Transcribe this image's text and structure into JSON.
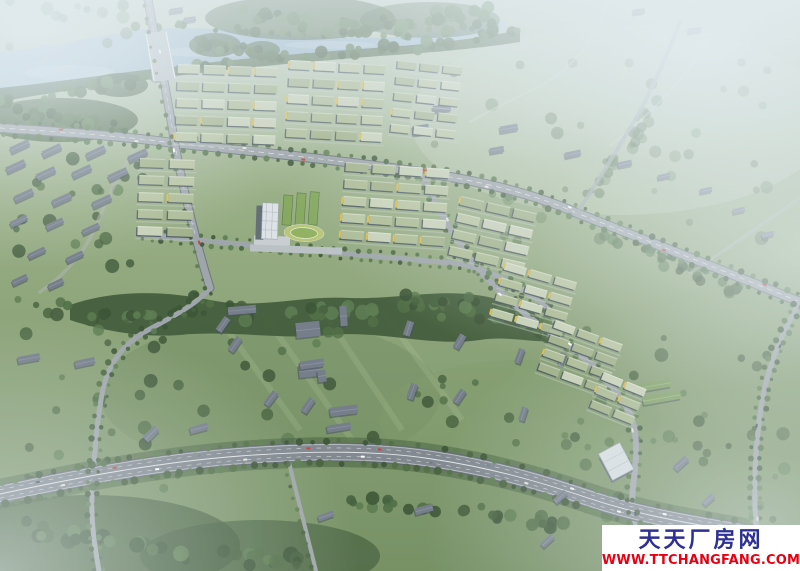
{
  "watermark": {
    "site_name": "天天厂房网",
    "url": "WWW.TTCHANGFANG.COM"
  },
  "scene": {
    "description": "Aerial bird's-eye rendering of an industrial park master plan: river across the top, grid clusters of green-roofed factory buildings with yellow accents, central white office tower with oval running track, tree bands, rural gray-roofed buildings in surrounding fields, and a wide tree-lined highway curving across the bottom, fading into blue-white haze at the edges.",
    "colors": {
      "haze": "#e4edf2",
      "grass_top": "#c3d1c0",
      "grass_mid": "#93a97d",
      "grass_low": "#6f8a5b",
      "water": "#a8c2d4",
      "water_deep": "#8fadc2",
      "tree_deep": "#35502e",
      "road_fill": "#9aa1a6",
      "road_edge": "#666e75",
      "highway_fill": "#7b828a",
      "highway_edge": "#565e66",
      "road_line": "#ffffff",
      "roof_sage": "#a9b88f",
      "roof_pale": "#c2ccae",
      "facade": "#3f4b54",
      "accent_yellow": "#e2b83d",
      "campus_green": "#7fa355",
      "track_ring": "#b5c272",
      "track_field": "#8cae58",
      "gray_roof": "#6d7683",
      "gray_dark": "#3d4650",
      "white_bldg": "#d7dde1",
      "tower": "#dce1e5",
      "wm_navy": "#2e3192",
      "wm_red": "#e60012"
    },
    "tree_shades": [
      "#324b2b",
      "#3d5933",
      "#48673c",
      "#547547"
    ],
    "roof_shades": [
      "#a9b88f",
      "#b6c29d",
      "#9dad83",
      "#c6cfb4"
    ],
    "car_colors": [
      "#f2f4f5",
      "#ffffff",
      "#39434d",
      "#c23b2e",
      "#6b7885",
      "#e8e4d8"
    ],
    "clusters": [
      {
        "id": "a1",
        "x": 178,
        "y": 64,
        "rot": 2,
        "rows": 5,
        "cols": 4,
        "w": 22,
        "h": 9,
        "gx": 4,
        "gy": 8,
        "seed": 11,
        "yellow": 0.3
      },
      {
        "id": "a2",
        "x": 290,
        "y": 60,
        "rot": 3,
        "rows": 5,
        "cols": 4,
        "w": 21,
        "h": 9,
        "gx": 4,
        "gy": 8,
        "seed": 22,
        "yellow": 0.3
      },
      {
        "id": "a3",
        "x": 398,
        "y": 60,
        "rot": 6,
        "rows": 5,
        "cols": 3,
        "w": 19,
        "h": 8,
        "gx": 4,
        "gy": 8,
        "seed": 33,
        "yellow": 0.25
      },
      {
        "id": "b-left",
        "x": 140,
        "y": 158,
        "rot": 2,
        "rows": 5,
        "cols": 2,
        "w": 25,
        "h": 9,
        "gx": 5,
        "gy": 8,
        "seed": 44,
        "yellow": 0.35
      },
      {
        "id": "b-right",
        "x": 346,
        "y": 162,
        "rot": 4,
        "rows": 5,
        "cols": 4,
        "w": 23,
        "h": 9,
        "gx": 4,
        "gy": 8,
        "seed": 55,
        "yellow": 0.35
      },
      {
        "id": "c1",
        "x": 462,
        "y": 196,
        "rot": 13,
        "rows": 4,
        "cols": 3,
        "w": 23,
        "h": 9,
        "gx": 4,
        "gy": 8,
        "seed": 66,
        "yellow": 0.3
      },
      {
        "id": "c2",
        "x": 506,
        "y": 262,
        "rot": 16,
        "rows": 4,
        "cols": 3,
        "w": 22,
        "h": 8,
        "gx": 4,
        "gy": 8,
        "seed": 77,
        "yellow": 0.35
      },
      {
        "id": "c3",
        "x": 556,
        "y": 320,
        "rot": 20,
        "rows": 4,
        "cols": 3,
        "w": 21,
        "h": 8,
        "gx": 4,
        "gy": 7,
        "seed": 88,
        "yellow": 0.4
      },
      {
        "id": "c4",
        "x": 604,
        "y": 372,
        "rot": 22,
        "rows": 3,
        "cols": 2,
        "w": 21,
        "h": 8,
        "gx": 4,
        "gy": 7,
        "seed": 99,
        "yellow": 0.4
      }
    ],
    "gray_buildings": [
      [
        10,
        143,
        20,
        7,
        -25
      ],
      [
        42,
        147,
        20,
        7,
        -25
      ],
      [
        86,
        149,
        20,
        7,
        -25
      ],
      [
        128,
        152,
        20,
        7,
        -25
      ],
      [
        6,
        163,
        20,
        7,
        -25
      ],
      [
        36,
        170,
        20,
        7,
        -25
      ],
      [
        72,
        168,
        20,
        7,
        -25
      ],
      [
        108,
        171,
        20,
        7,
        -25
      ],
      [
        14,
        192,
        20,
        7,
        -25
      ],
      [
        52,
        196,
        20,
        7,
        -25
      ],
      [
        92,
        198,
        20,
        7,
        -25
      ],
      [
        10,
        218,
        18,
        6,
        -25
      ],
      [
        46,
        221,
        18,
        6,
        -25
      ],
      [
        82,
        226,
        18,
        6,
        -25
      ],
      [
        28,
        250,
        18,
        6,
        -25
      ],
      [
        66,
        254,
        18,
        6,
        -25
      ],
      [
        12,
        277,
        16,
        6,
        -25
      ],
      [
        48,
        281,
        16,
        6,
        -25
      ],
      [
        170,
        8,
        13,
        5,
        -8
      ],
      [
        184,
        17,
        12,
        5,
        -8
      ],
      [
        228,
        306,
        28,
        8,
        -5
      ],
      [
        215,
        321,
        16,
        7,
        -55
      ],
      [
        227,
        341,
        16,
        7,
        -55
      ],
      [
        296,
        322,
        24,
        15,
        -6
      ],
      [
        299,
        364,
        20,
        13,
        -6
      ],
      [
        340,
        306,
        7,
        20,
        -4
      ],
      [
        330,
        406,
        28,
        9,
        -7
      ],
      [
        327,
        424,
        24,
        7,
        -9
      ],
      [
        401,
        325,
        15,
        7,
        -72
      ],
      [
        452,
        338,
        15,
        7,
        -58
      ],
      [
        404,
        388,
        16,
        7,
        -70
      ],
      [
        452,
        393,
        15,
        7,
        -56
      ],
      [
        512,
        353,
        15,
        6,
        -70
      ],
      [
        555,
        356,
        13,
        6,
        -70
      ],
      [
        516,
        411,
        14,
        6,
        -72
      ],
      [
        413,
        125,
        16,
        10,
        -8
      ],
      [
        433,
        105,
        18,
        7,
        -8
      ],
      [
        500,
        125,
        18,
        7,
        -10
      ],
      [
        490,
        147,
        14,
        6,
        -10
      ],
      [
        565,
        151,
        16,
        6,
        -12
      ],
      [
        618,
        161,
        14,
        6,
        -12
      ],
      [
        658,
        174,
        12,
        5,
        -12
      ],
      [
        700,
        188,
        12,
        5,
        -12
      ],
      [
        633,
        9,
        12,
        5,
        -8
      ],
      [
        688,
        28,
        13,
        5,
        -8
      ],
      [
        733,
        208,
        12,
        5,
        -12
      ],
      [
        762,
        232,
        12,
        5,
        -12
      ],
      [
        18,
        355,
        22,
        7,
        -10
      ],
      [
        75,
        359,
        20,
        7,
        -12
      ],
      [
        190,
        425,
        18,
        7,
        -15
      ],
      [
        143,
        430,
        16,
        8,
        -45
      ],
      [
        300,
        360,
        24,
        8,
        -8
      ],
      [
        318,
        370,
        8,
        12,
        -8
      ],
      [
        263,
        395,
        16,
        7,
        -52
      ],
      [
        300,
        402,
        16,
        7,
        -55
      ],
      [
        415,
        506,
        18,
        7,
        -15
      ],
      [
        318,
        513,
        16,
        6,
        -20
      ],
      [
        553,
        494,
        15,
        6,
        -42
      ],
      [
        540,
        538,
        15,
        6,
        -42
      ],
      [
        673,
        460,
        16,
        7,
        -42
      ],
      [
        702,
        497,
        13,
        6,
        -42
      ],
      [
        633,
        382,
        38,
        8,
        -10,
        "g"
      ],
      [
        643,
        394,
        38,
        8,
        -10,
        "g"
      ]
    ],
    "forest_spines": [
      {
        "pts": [
          [
            128,
            24
          ],
          [
            200,
            28
          ],
          [
            260,
            31
          ],
          [
            320,
            34
          ],
          [
            390,
            36
          ],
          [
            450,
            30
          ],
          [
            505,
            22
          ]
        ],
        "n": 40,
        "s": 5,
        "r0": 2.5,
        "r1": 5.5,
        "seed": 61
      },
      {
        "pts": [
          [
            0,
            100
          ],
          [
            60,
            93
          ],
          [
            120,
            82
          ],
          [
            175,
            73
          ],
          [
            230,
            63
          ],
          [
            290,
            57
          ],
          [
            350,
            52
          ],
          [
            410,
            47
          ],
          [
            470,
            40
          ],
          [
            515,
            32
          ]
        ],
        "n": 60,
        "s": 7,
        "r0": 3,
        "r1": 6.5,
        "seed": 62
      },
      {
        "pts": [
          [
            235,
            12
          ],
          [
            285,
            20
          ],
          [
            335,
            27
          ],
          [
            385,
            24
          ],
          [
            435,
            17
          ],
          [
            485,
            11
          ]
        ],
        "n": 40,
        "s": 12,
        "r0": 3.5,
        "r1": 7,
        "seed": 63
      },
      {
        "pts": [
          [
            0,
            112
          ],
          [
            45,
            116
          ],
          [
            90,
            122
          ],
          [
            130,
            130
          ]
        ],
        "n": 28,
        "s": 9,
        "r0": 3.5,
        "r1": 7,
        "seed": 64
      },
      {
        "pts": [
          [
            200,
            44
          ],
          [
            235,
            48
          ],
          [
            265,
            52
          ]
        ],
        "n": 16,
        "s": 8,
        "r0": 3,
        "r1": 6,
        "seed": 65
      },
      {
        "pts": [
          [
            68,
            312
          ],
          [
            140,
            316
          ],
          [
            210,
            308
          ],
          [
            280,
            316
          ],
          [
            350,
            310
          ],
          [
            420,
            300
          ],
          [
            480,
            308
          ],
          [
            528,
            320
          ],
          [
            552,
            336
          ]
        ],
        "n": 85,
        "s": 11,
        "r0": 3.5,
        "r1": 7.5,
        "seed": 66
      },
      {
        "pts": [
          [
            5,
            525
          ],
          [
            60,
            535
          ],
          [
            120,
            545
          ],
          [
            180,
            552
          ],
          [
            240,
            558
          ],
          [
            300,
            562
          ]
        ],
        "n": 45,
        "s": 14,
        "r0": 4,
        "r1": 8,
        "seed": 67
      },
      {
        "pts": [
          [
            340,
            500
          ],
          [
            420,
            505
          ],
          [
            500,
            515
          ],
          [
            560,
            528
          ]
        ],
        "n": 30,
        "s": 10,
        "r0": 3.5,
        "r1": 7,
        "seed": 68
      },
      {
        "pts": [
          [
            585,
            200
          ],
          [
            610,
            170
          ],
          [
            635,
            135
          ],
          [
            655,
            100
          ]
        ],
        "n": 20,
        "s": 9,
        "r0": 3,
        "r1": 6,
        "seed": 69,
        "o": 0.55
      },
      {
        "pts": [
          [
            600,
            230
          ],
          [
            650,
            252
          ],
          [
            700,
            275
          ],
          [
            750,
            295
          ]
        ],
        "n": 25,
        "s": 9,
        "r0": 3,
        "r1": 6,
        "seed": 70,
        "o": 0.75
      }
    ],
    "forest_regions": [
      {
        "x": 0,
        "y": 290,
        "w": 190,
        "h": 200,
        "n": 30,
        "seed": 71,
        "o": 0.8
      },
      {
        "x": 185,
        "y": 295,
        "w": 380,
        "h": 150,
        "n": 32,
        "seed": 72,
        "o": 0.8
      },
      {
        "x": 420,
        "y": 55,
        "w": 360,
        "h": 190,
        "n": 40,
        "seed": 73,
        "o": 0.45
      },
      {
        "x": 560,
        "y": 330,
        "w": 230,
        "h": 140,
        "n": 22,
        "seed": 74,
        "o": 0.7
      },
      {
        "x": 0,
        "y": 0,
        "w": 130,
        "h": 48,
        "n": 12,
        "seed": 75,
        "o": 0.5
      },
      {
        "x": 600,
        "y": 430,
        "w": 190,
        "h": 90,
        "n": 16,
        "seed": 76,
        "o": 0.6
      },
      {
        "x": 0,
        "y": 130,
        "w": 150,
        "h": 150,
        "n": 22,
        "seed": 77,
        "o": 0.75
      }
    ],
    "roadside_trees": [
      {
        "road": "road-highway",
        "step": 11,
        "offset": 11,
        "r": 3.2,
        "seed": 31
      },
      {
        "road": "road-highway",
        "step": 13,
        "offset": -11,
        "r": 3.0,
        "seed": 32
      },
      {
        "road": "road-artery",
        "step": 12,
        "offset": 6.5,
        "r": 2.6,
        "seed": 33
      },
      {
        "road": "road-artery",
        "step": 12,
        "offset": -6.5,
        "r": 2.6,
        "seed": 34
      },
      {
        "road": "road-front",
        "step": 10,
        "offset": 4.5,
        "r": 2.2,
        "seed": 35
      },
      {
        "road": "road-front",
        "step": 12,
        "offset": -4.5,
        "r": 2.2,
        "seed": 36
      },
      {
        "road": "road-b",
        "step": 12,
        "offset": 5,
        "r": 2.4,
        "seed": 37
      },
      {
        "road": "road-b",
        "step": 12,
        "offset": -5,
        "r": 2.4,
        "seed": 38
      },
      {
        "road": "road-vsouth",
        "step": 11,
        "offset": 4.5,
        "r": 2.6,
        "seed": 39
      },
      {
        "road": "road-vsouth",
        "step": 11,
        "offset": -4.5,
        "r": 2.4,
        "seed": 40
      },
      {
        "road": "road-right",
        "step": 10,
        "offset": 4.5,
        "r": 2.6,
        "seed": 41
      },
      {
        "road": "road-right",
        "step": 10,
        "offset": -4.5,
        "r": 2.4,
        "seed": 42
      },
      {
        "road": "road-vertical",
        "step": 14,
        "offset": 5,
        "r": 2.0,
        "seed": 43
      },
      {
        "road": "road-branch290",
        "step": 12,
        "offset": 4,
        "r": 2.2,
        "seed": 44
      }
    ],
    "cars": [
      {
        "road": "road-highway",
        "count": 16,
        "offset": 4,
        "seed": 5
      },
      {
        "road": "road-artery",
        "count": 9,
        "offset": 2.5,
        "seed": 9
      },
      {
        "road": "road-b",
        "count": 5,
        "offset": 2,
        "seed": 13
      },
      {
        "road": "road-vertical",
        "count": 3,
        "offset": 2,
        "seed": 17
      },
      {
        "road": "road-right",
        "count": 3,
        "offset": 2,
        "seed": 21
      }
    ]
  }
}
